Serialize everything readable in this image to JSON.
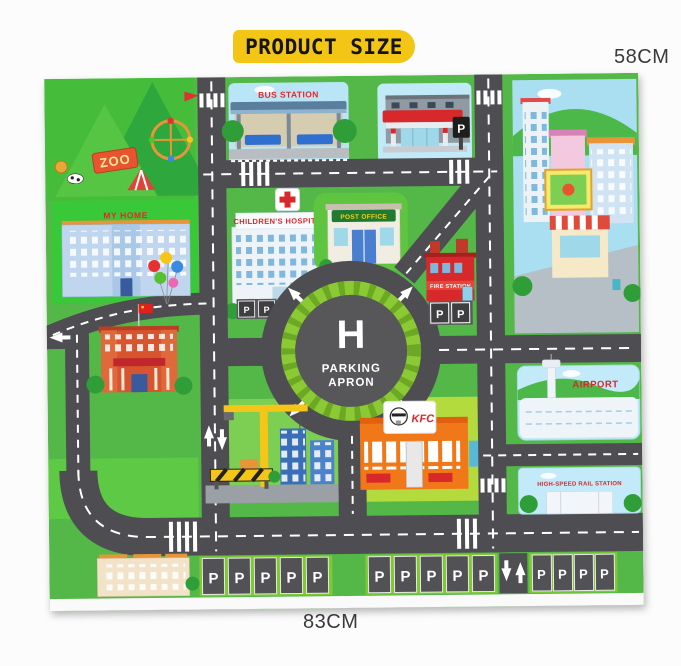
{
  "header": {
    "badge": "PRODUCT SIZE"
  },
  "dimensions": {
    "height": "58CM",
    "width": "83CM"
  },
  "colors": {
    "badge_bg": "#F3C515",
    "label_red": "#D7282C",
    "mat_green": "#54B848",
    "road_gray": "#4E4E52",
    "ring_green": "#8BCA34",
    "sky_blue": "#BFE7F6"
  },
  "mat": {
    "zoo": {
      "sign": "ZOO"
    },
    "bus_station": {
      "label": "BUS STATION"
    },
    "gas_station": {
      "parking": "P"
    },
    "my_home": {
      "label": "MY HOME"
    },
    "hospital": {
      "label": "CHILDREN'S HOSPITAL",
      "p1": "P",
      "p2": "P"
    },
    "post_office": {
      "label": "POST OFFICE"
    },
    "fire_station": {
      "label": "FIRE STATION",
      "p1": "P",
      "p2": "P"
    },
    "roundabout": {
      "letter": "H",
      "line1": "PARKING",
      "line2": "APRON"
    },
    "kfc": {
      "label": "KFC"
    },
    "airport": {
      "label": "AIRPORT"
    },
    "rail": {
      "label": "HIGH-SPEED RAIL STATION"
    },
    "parking": {
      "p": "P"
    }
  }
}
